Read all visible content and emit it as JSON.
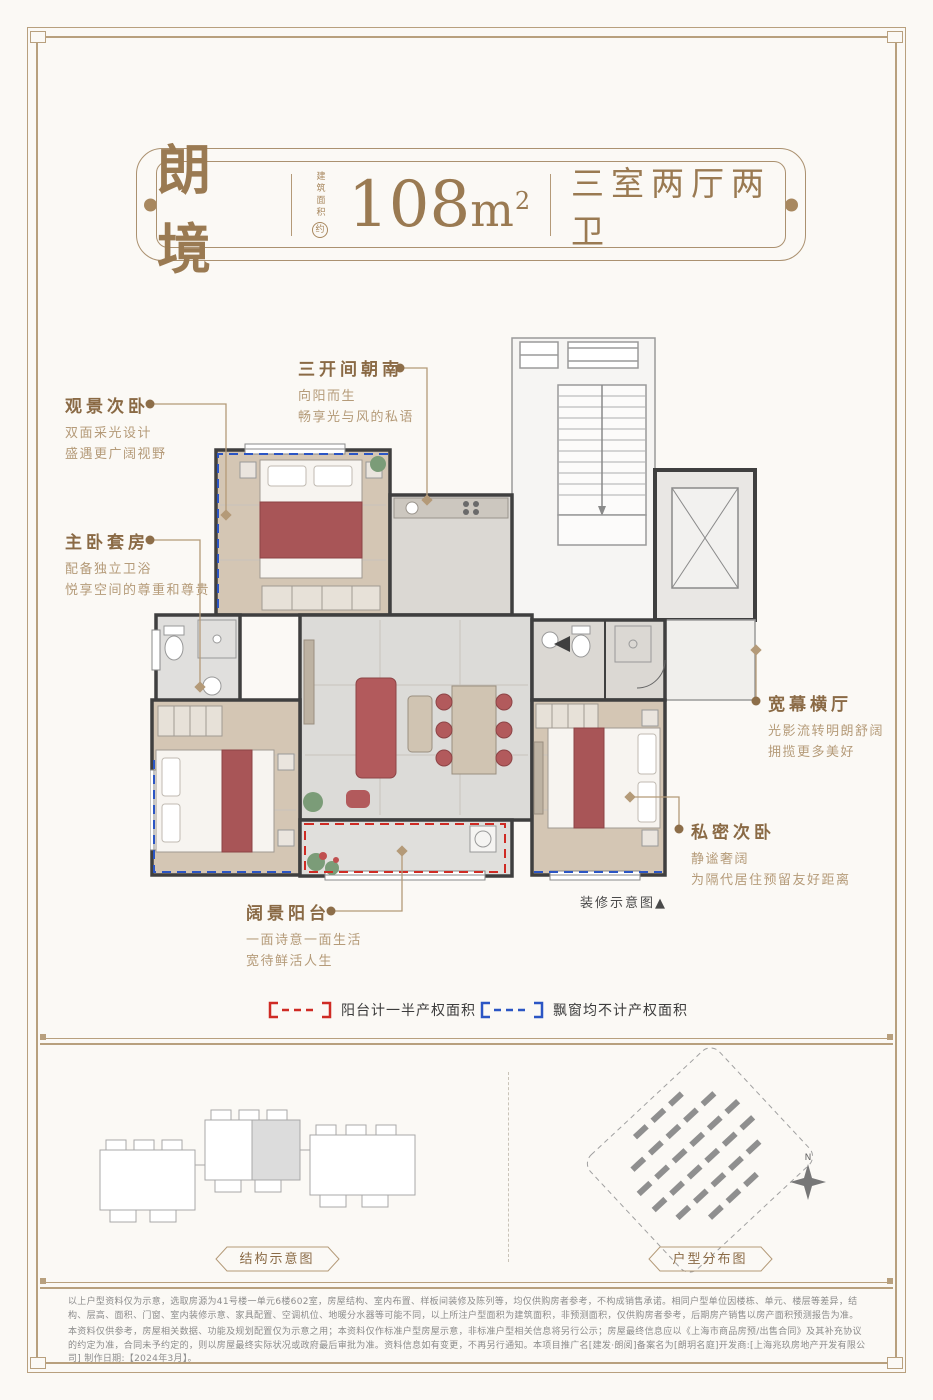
{
  "colors": {
    "accent": "#9a7a52",
    "frame": "#b8a07e",
    "balcony_dash": "#cf2b24",
    "baywindow_dash": "#2b55c4",
    "wall": "#3f3f3f",
    "wood": "#d4c6b4",
    "bed_throw": "#a85557"
  },
  "header": {
    "brand": "朗境",
    "area_label": "建筑面积",
    "area_approx": "约",
    "area_value": "108",
    "area_unit": "m",
    "area_sup": "2",
    "layout": "三室两厅两卫"
  },
  "annotations": [
    {
      "title": "三开间朝南",
      "line1": "向阳而生",
      "line2": "畅享光与风的私语"
    },
    {
      "title": "观景次卧",
      "line1": "双面采光设计",
      "line2": "盛遇更广阔视野"
    },
    {
      "title": "主卧套房",
      "line1": "配备独立卫浴",
      "line2": "悦享空间的尊重和尊贵"
    },
    {
      "title": "宽幕横厅",
      "line1": "光影流转明朗舒阔",
      "line2": "拥揽更多美好"
    },
    {
      "title": "私密次卧",
      "line1": "静谧奢阔",
      "line2": "为隔代居住预留友好距离"
    },
    {
      "title": "阔景阳台",
      "line1": "一面诗意一面生活",
      "line2": "宽待鲜活人生"
    }
  ],
  "floorplan": {
    "caption": "装修示意图▲"
  },
  "legend": {
    "balcony": "阳台计一半产权面积",
    "bay_window": "飘窗均不计产权面积"
  },
  "diagrams": {
    "structure_label": "结构示意图",
    "distribution_label": "户型分布图",
    "compass": "N"
  },
  "disclaimer": {
    "p1": "以上户型资料仅为示意，选取房源为41号楼一单元6楼602室，房屋结构、室内布置、样板间装修及陈列等，均仅供购房者参考，不构成销售承诺。相同户型单位因楼栋、单元、楼层等差异，结构、层高、面积、门窗、室内装修示意、家具配置、空调机位、地暖分水器等可能不同，以上所注户型面积为建筑面积，非预测面积，仅供购房者参考，后期房产销售以房产面积预测报告为准。",
    "p2": "本资料仅供参考，房屋相关数据、功能及规划配置仅为示意之用；本资料仅作标准户型房屋示意，非标准户型相关信息将另行公示；房屋最终信息应以《上海市商品房预/出售合同》及其补充协议的约定为准，合同未予约定的，则以房屋最终实际状况或政府最后审批为准。资料信息如有变更，不再另行通知。本项目推广名[建发·朗阅]备案名为[朗玥名庭]开发商:[上海兆玖房地产开发有限公司] 制作日期:【2024年3月】。"
  }
}
